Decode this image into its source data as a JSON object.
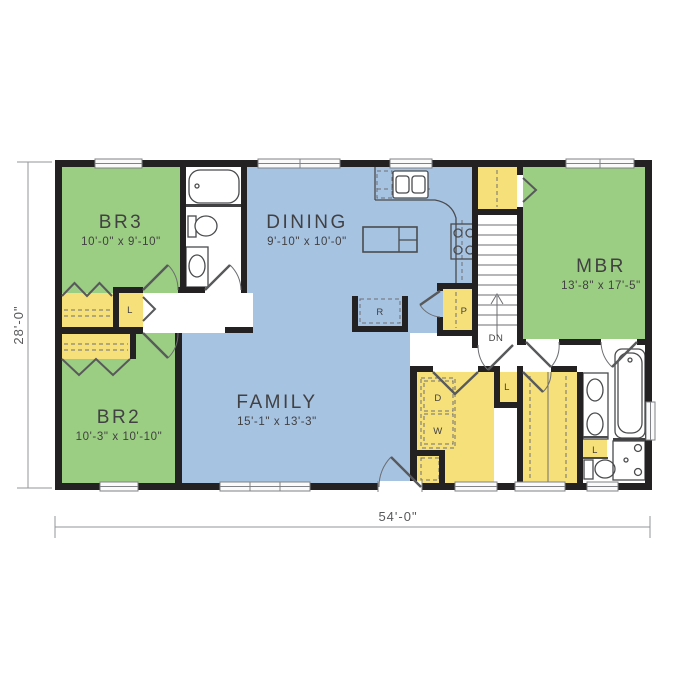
{
  "colors": {
    "bedroom_green": "#9bce83",
    "living_blue": "#a6c3e2",
    "closet_yellow": "#f6e07a",
    "wall": "#242122",
    "dim_text": "#58595b"
  },
  "dimensions": {
    "overall_width": "54'-0\"",
    "overall_depth": "28'-0\""
  },
  "rooms": {
    "br3": {
      "name": "BR3",
      "size": "10'-0\" x 9'-10\""
    },
    "dining": {
      "name": "DINING",
      "size": "9'-10\" x 10'-0\""
    },
    "mbr": {
      "name": "MBR",
      "size": "13'-8\" x 17'-5\""
    },
    "br2": {
      "name": "BR2",
      "size": "10'-3\" x 10'-10\""
    },
    "family": {
      "name": "FAMILY",
      "size": "15'-1\" x 13'-3\""
    }
  },
  "labels": {
    "down": "DN",
    "refrigerator": "R",
    "pantry": "P",
    "dryer": "D",
    "washer": "W",
    "linen": "L"
  }
}
